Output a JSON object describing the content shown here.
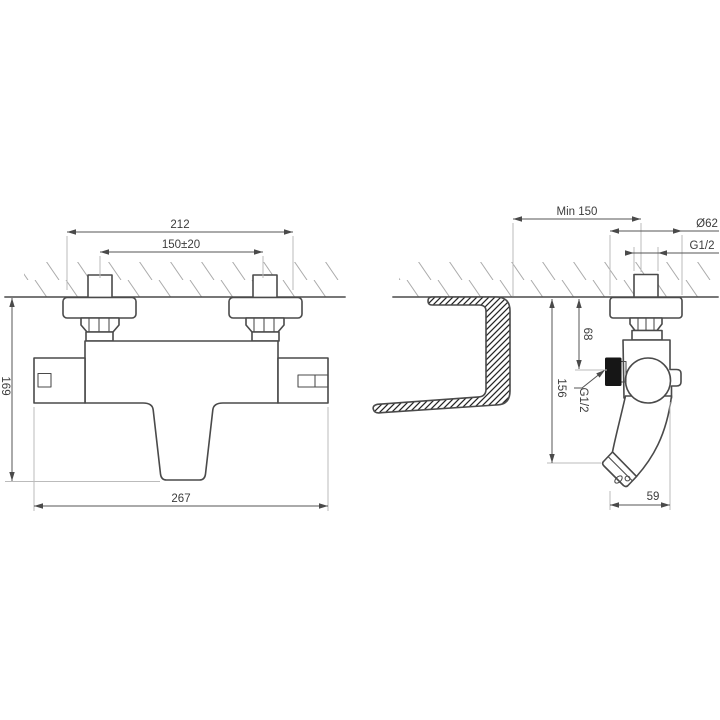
{
  "drawing": {
    "type": "technical-dimension-drawing",
    "subject": "wall-mounted thermostatic bath shower mixer",
    "front_view": {
      "dim_escutcheon_outer_width": "212",
      "dim_inlet_spacing": "150±20",
      "dim_height": "169",
      "dim_overall_width": "267"
    },
    "side_view": {
      "dim_min_distance": "Min 150",
      "dim_escutcheon_diameter": "Ø62",
      "dim_inlet_thread": "G1/2",
      "dim_wall_to_outlet": "68",
      "dim_wall_to_spout": "156",
      "label_shower_outlet_thread": "G1/2",
      "dim_spout_reach": "59"
    },
    "colors": {
      "outline": "#4a4a4a",
      "dimension_line": "#555555",
      "extension_line": "#bbbbbb",
      "wall_hatch": "#aaaaaa",
      "section_hatch": "#262626",
      "text": "#3c3c3c",
      "background": "#ffffff"
    }
  }
}
